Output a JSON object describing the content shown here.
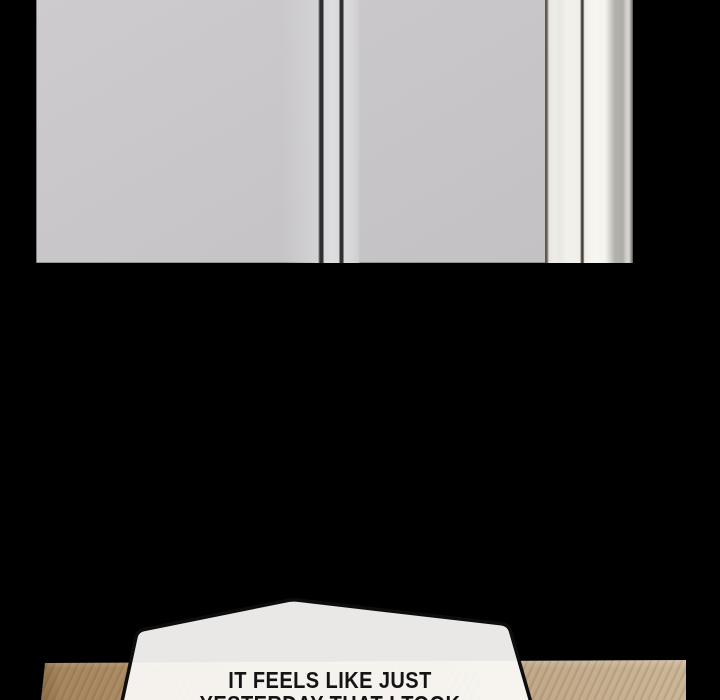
{
  "speech_bubble": {
    "line1": "IT FEELS LIKE JUST",
    "line2": "YESTERDAY THAT I TOOK"
  },
  "colors": {
    "background": "#000000",
    "panel_gray": "#c8c6c8",
    "stripe_light": "#dedde0",
    "divider_dark": "#2f2f2f",
    "molding_white": "#f3f1ec",
    "molding_bright": "#f8f6f1",
    "molding_shadow": "#b2b0ab",
    "molding_edge_dark": "#5a5148",
    "wood_light": "#cbb597",
    "wood_mid": "#b79c7a",
    "wood_dark": "#a5855c",
    "bubble_fill": "#fbfaf8",
    "bubble_outline": "#0d0d0d",
    "dialogue_text": "#141414"
  }
}
